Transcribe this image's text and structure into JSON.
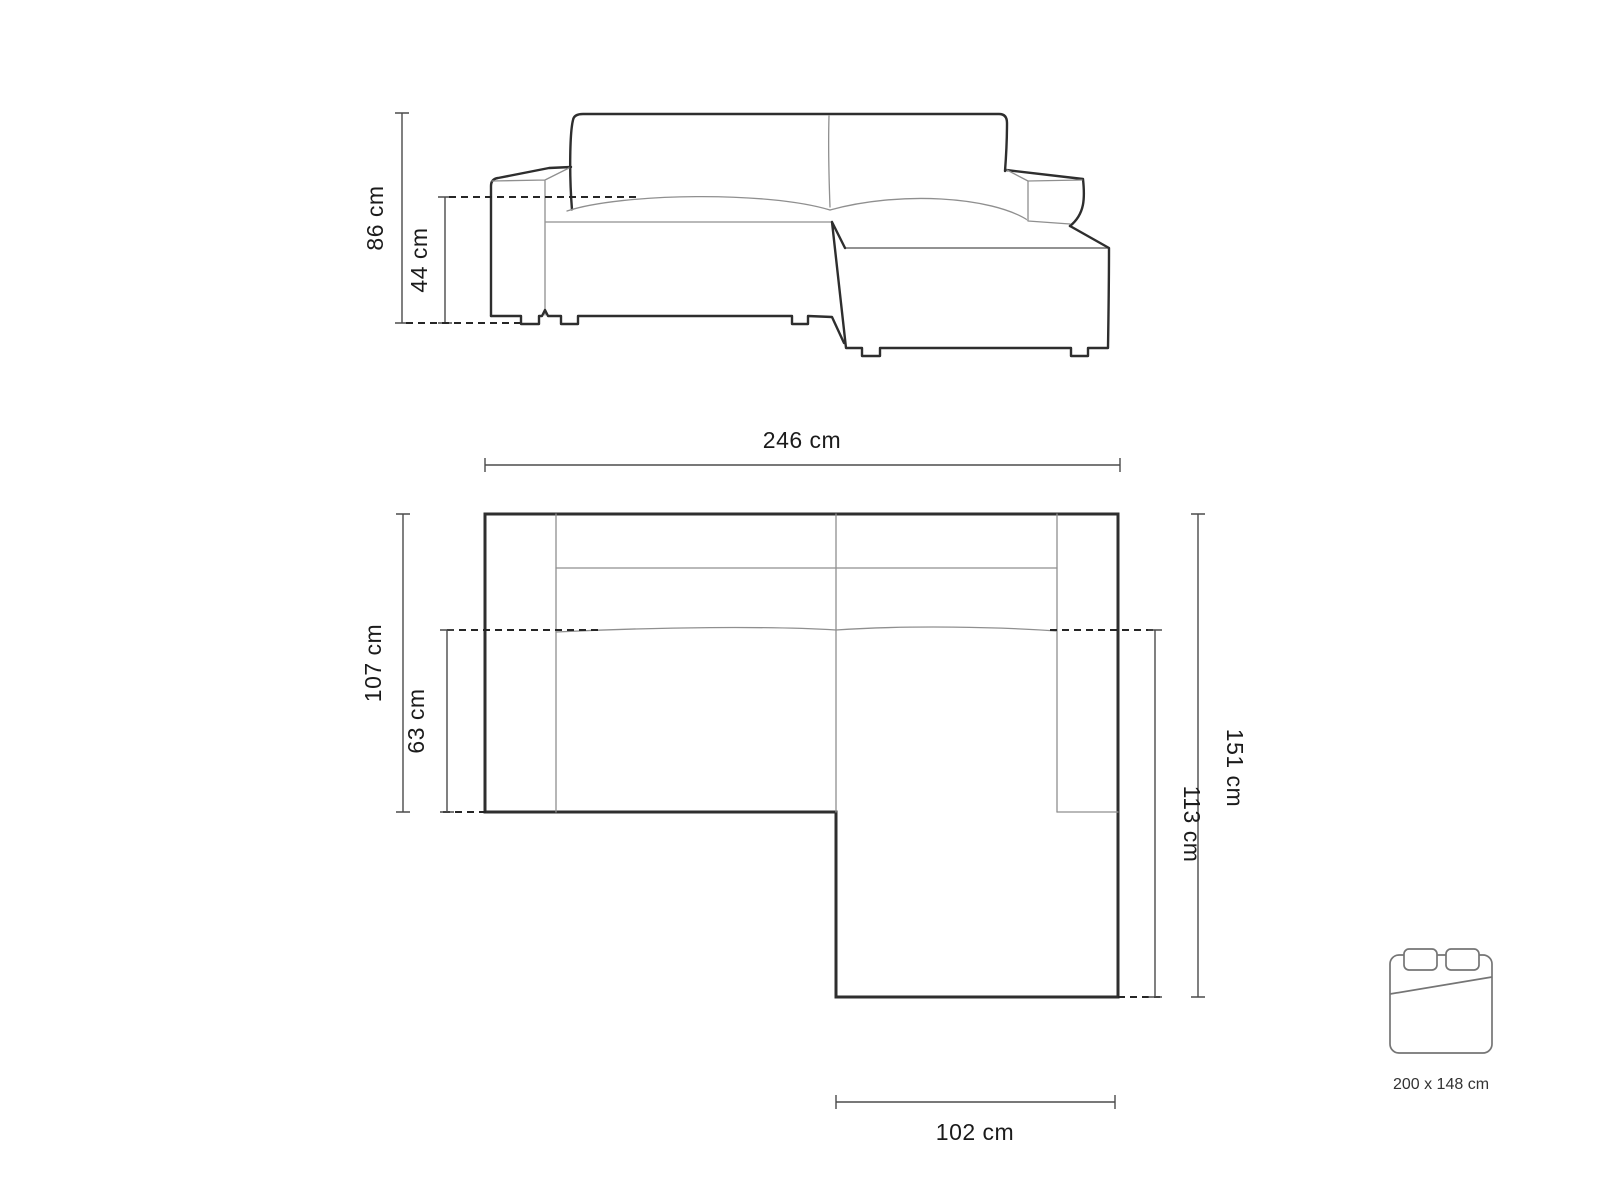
{
  "page": {
    "description": "Corner sofa technical dimension diagram with front elevation view, top plan view and sleeping-area size indicator"
  },
  "colors": {
    "outline": "#2e2e2e",
    "thin": "#8f8f8f",
    "dim": "#4b4b4b",
    "dash": "#262626",
    "text": "#1b1b1b",
    "bed": "#757575",
    "background": "#ffffff"
  },
  "front_view": {
    "name": "sofa front elevation",
    "label_total_height": "86 cm",
    "label_seat_height": "44 cm"
  },
  "top_view": {
    "name": "sofa top plan",
    "label_total_width": "246 cm",
    "label_total_depth": "107 cm",
    "label_seat_depth": "63 cm",
    "label_chaise_total": "151 cm",
    "label_chaise_inner": "113 cm",
    "label_chaise_width": "102 cm"
  },
  "sleeping_area": {
    "name": "sleeping function size",
    "label_size": "200 x 148 cm"
  }
}
